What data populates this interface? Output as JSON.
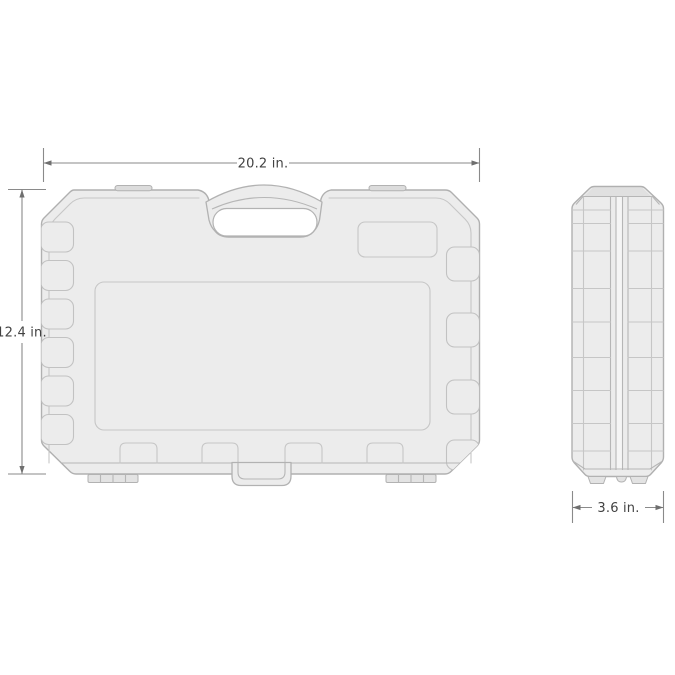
{
  "figure": {
    "kind": "product-dimension-diagram",
    "subject": "blow-molded tool storage case, front and side orthographic views",
    "background": "#ffffff"
  },
  "palette": {
    "case_fill": "#ececec",
    "case_stroke": "#b0b0b0",
    "detail_stroke": "#c6c6c6",
    "recess_strip_fill": "#e0e0e0",
    "center_channel_fill": "#f5f5f5",
    "handle_cutout_fill": "#ffffff",
    "dimension_line": "#8a8a8a",
    "dimension_text": "#424242"
  },
  "dimensions": {
    "width": {
      "label": "20.2 in."
    },
    "height": {
      "label": "12.4 in."
    },
    "depth": {
      "label": "3.6 in."
    }
  }
}
